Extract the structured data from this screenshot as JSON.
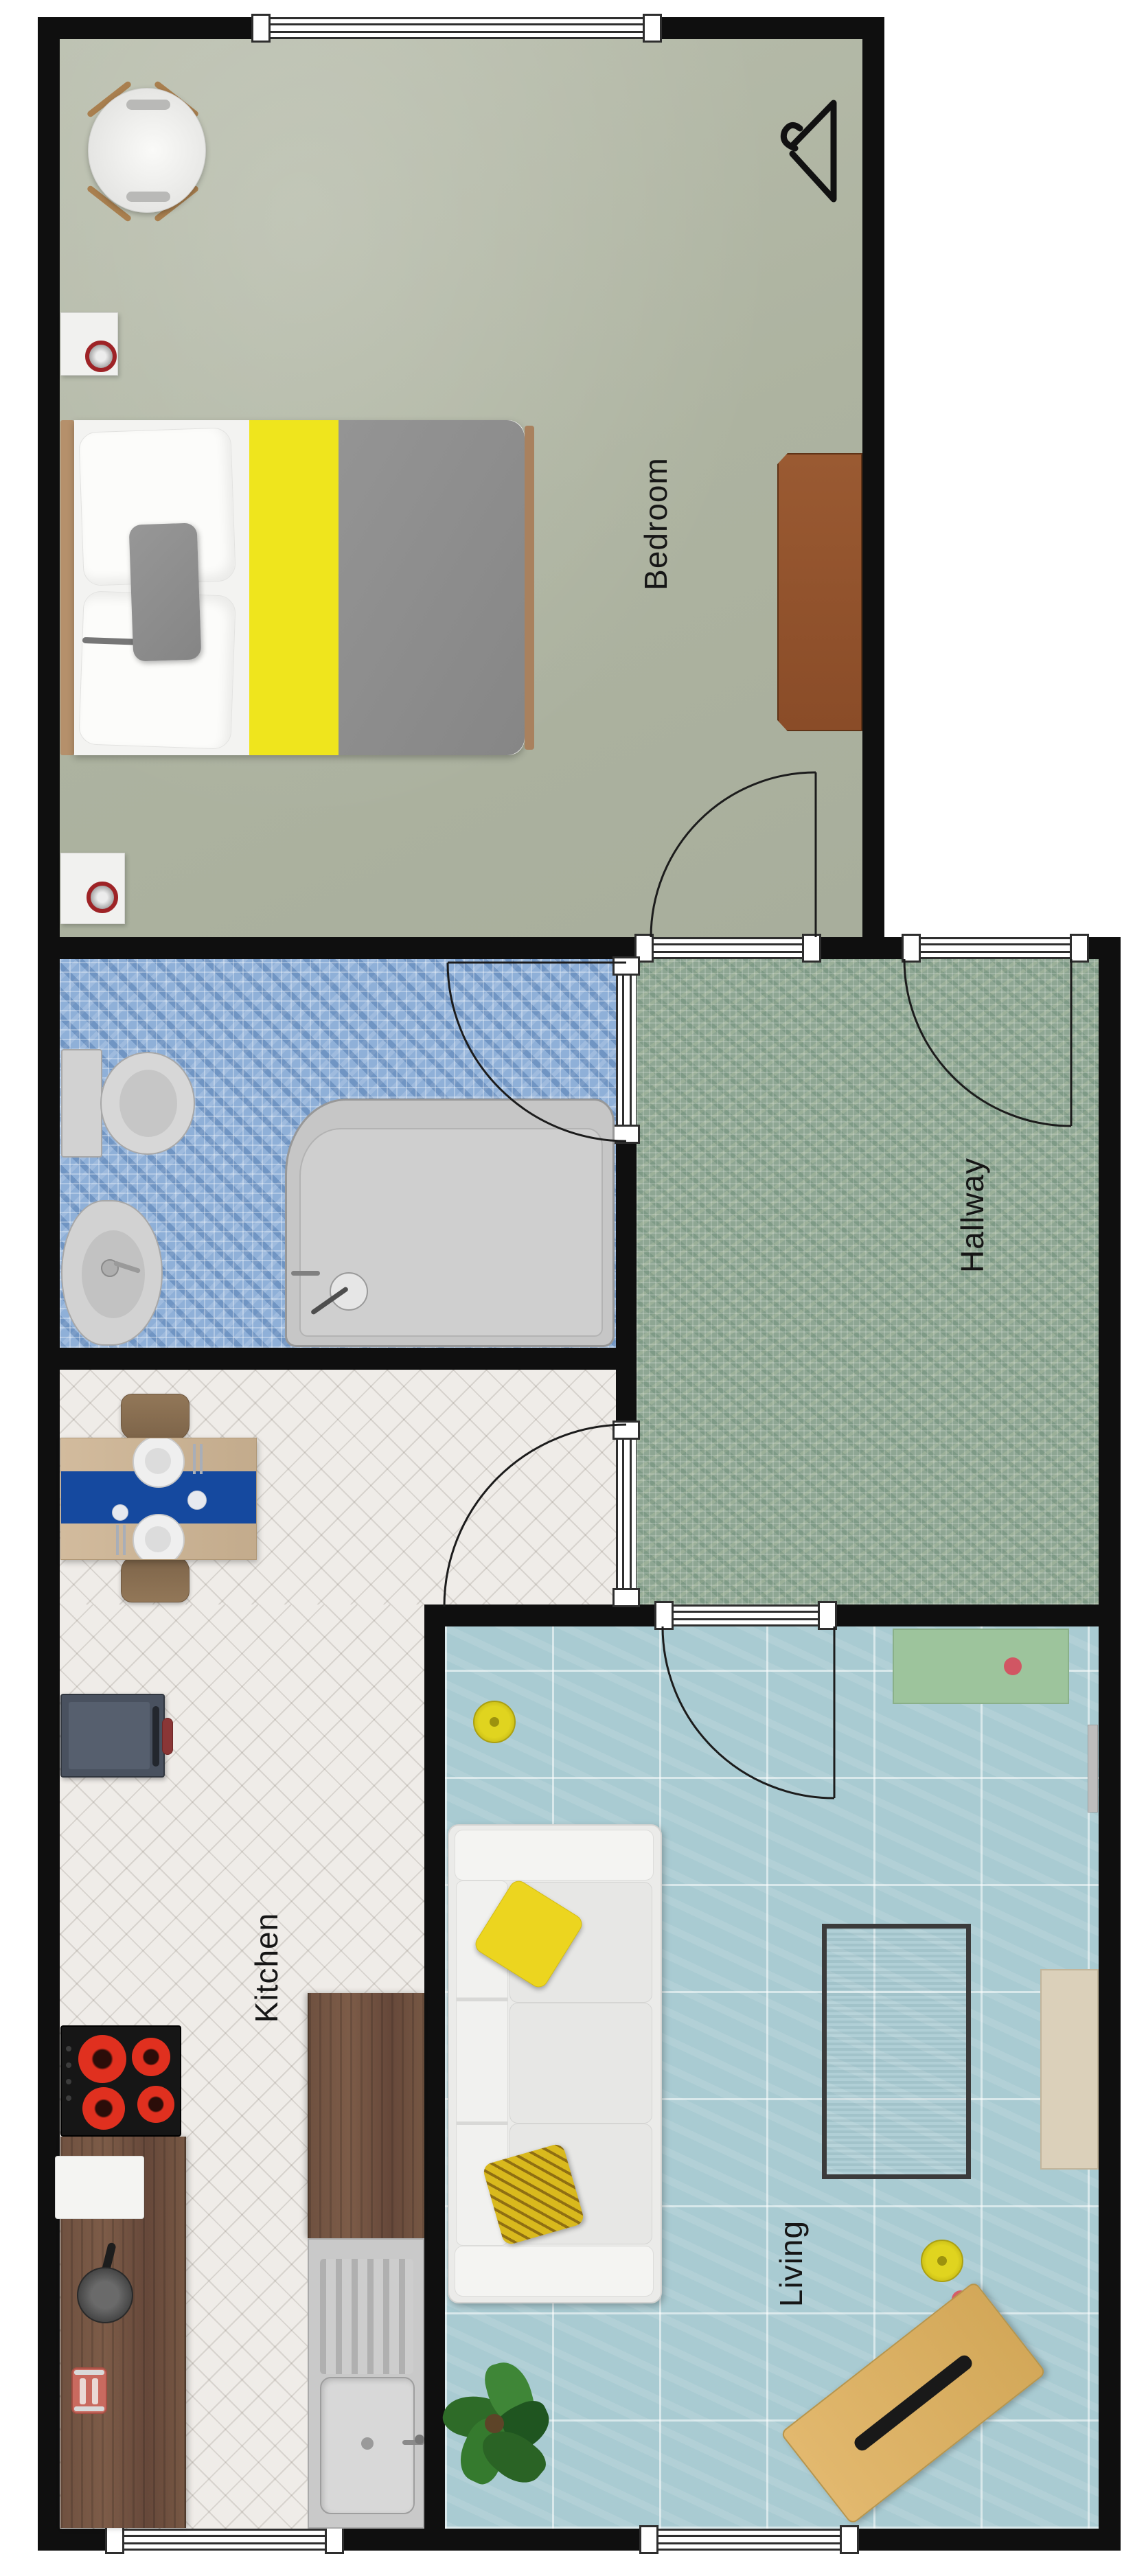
{
  "rooms": {
    "bedroom": {
      "label": "Bedroom"
    },
    "hallway": {
      "label": "Hallway"
    },
    "kitchen": {
      "label": "Kitchen"
    },
    "living": {
      "label": "Living"
    },
    "bathroom": {
      "label": ""
    }
  },
  "palette": {
    "wall": "#0f0f0f",
    "bedroom_floor": "#b0b6a4",
    "bathroom_floor": "#8fb0d8",
    "hallway_floor": "#8ea693",
    "kitchen_floor": "#efece8",
    "living_floor": "#a9cbd2",
    "bed_blanket_yellow": "#efe51d",
    "bed_duvet_gray": "#8d8d8d",
    "table_runner_blue": "#15499f",
    "sideboard_green": "#9dc49c",
    "burner_red": "#e0301f",
    "wood_counter": "#6f5140",
    "desk_tan": "#ddb266"
  },
  "icons": {
    "hanger": "clothes-hanger-icon",
    "door_swings": [
      "bedroom-door",
      "front-door",
      "bathroom-door",
      "kitchen-door",
      "living-door"
    ]
  },
  "furniture": {
    "bedroom": [
      "armchair",
      "clothes-hanger",
      "nightstand-lamp",
      "nightstand-lamp",
      "double-bed",
      "dresser"
    ],
    "bathroom": [
      "toilet",
      "bidet",
      "bathtub"
    ],
    "kitchen": [
      "dining-table",
      "chair",
      "chair",
      "appliance",
      "cooktop",
      "counter",
      "cutting-board",
      "grinder",
      "toaster",
      "sink-counter",
      "sink"
    ],
    "living": [
      "sofa",
      "yellow-pillow",
      "chevron-pillow",
      "rug",
      "media-bench",
      "sideboard",
      "radiator",
      "pouf",
      "pouf",
      "plant",
      "desk",
      "laptop"
    ]
  }
}
